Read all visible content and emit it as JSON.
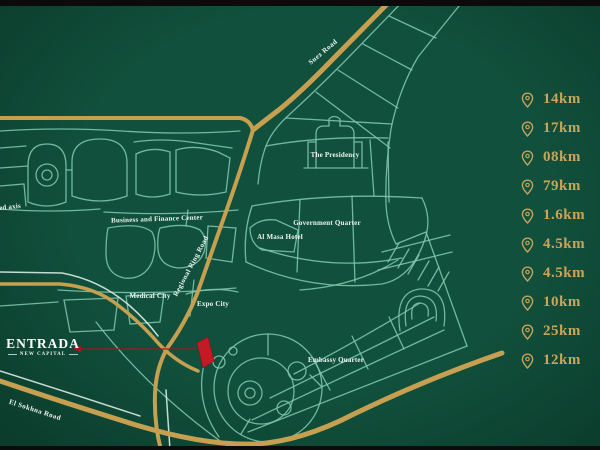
{
  "title": "Entrada New Capital location map",
  "colors": {
    "map_background": "#11503c",
    "letterbox": "#0b0b0b",
    "road_gold": "#c6a050",
    "road_teal": "#7ec6ad",
    "road_white": "#d8ece2",
    "marker_red": "#c41a26",
    "callout_red": "#a8141f",
    "distance_text_gold": "#c9a55c",
    "label_white": "#edf6f0"
  },
  "logo": {
    "brand": "ENTRADA",
    "tagline": "NEW CAPITAL"
  },
  "map": {
    "area_labels": [
      {
        "id": "axis-partial",
        "text": "ed axis"
      },
      {
        "id": "business-and-finance-center",
        "text": "Business and Finance Center"
      },
      {
        "id": "medical-city",
        "text": "Medical City"
      },
      {
        "id": "al-masa-hotel",
        "text": "Al Masa Hotel"
      },
      {
        "id": "government-quarter",
        "text": "Government Quarter"
      },
      {
        "id": "the-presidency",
        "text": "The Presidency"
      },
      {
        "id": "expo-city",
        "text": "Expo City"
      },
      {
        "id": "embassy-quarter",
        "text": "Embassy Quarter"
      }
    ],
    "road_labels": [
      {
        "id": "suez-road",
        "text": "Suez Road"
      },
      {
        "id": "regional-ring-road",
        "text": "Regional Ring Road"
      },
      {
        "id": "el-sokhna-road",
        "text": "El Sokhna Road"
      }
    ],
    "marker": {
      "id": "entrada-site-marker",
      "color": "#c41a26"
    }
  },
  "distances": {
    "items": [
      {
        "icon": "map-pin-icon",
        "value": "14km"
      },
      {
        "icon": "map-pin-icon",
        "value": "17km"
      },
      {
        "icon": "map-pin-icon",
        "value": "08km"
      },
      {
        "icon": "map-pin-icon",
        "value": "79km"
      },
      {
        "icon": "map-pin-icon",
        "value": "1.6km"
      },
      {
        "icon": "map-pin-icon",
        "value": "4.5km"
      },
      {
        "icon": "map-pin-icon",
        "value": "4.5km"
      },
      {
        "icon": "map-pin-icon",
        "value": "10km"
      },
      {
        "icon": "map-pin-icon",
        "value": "25km"
      },
      {
        "icon": "map-pin-icon",
        "value": "12km"
      }
    ]
  }
}
